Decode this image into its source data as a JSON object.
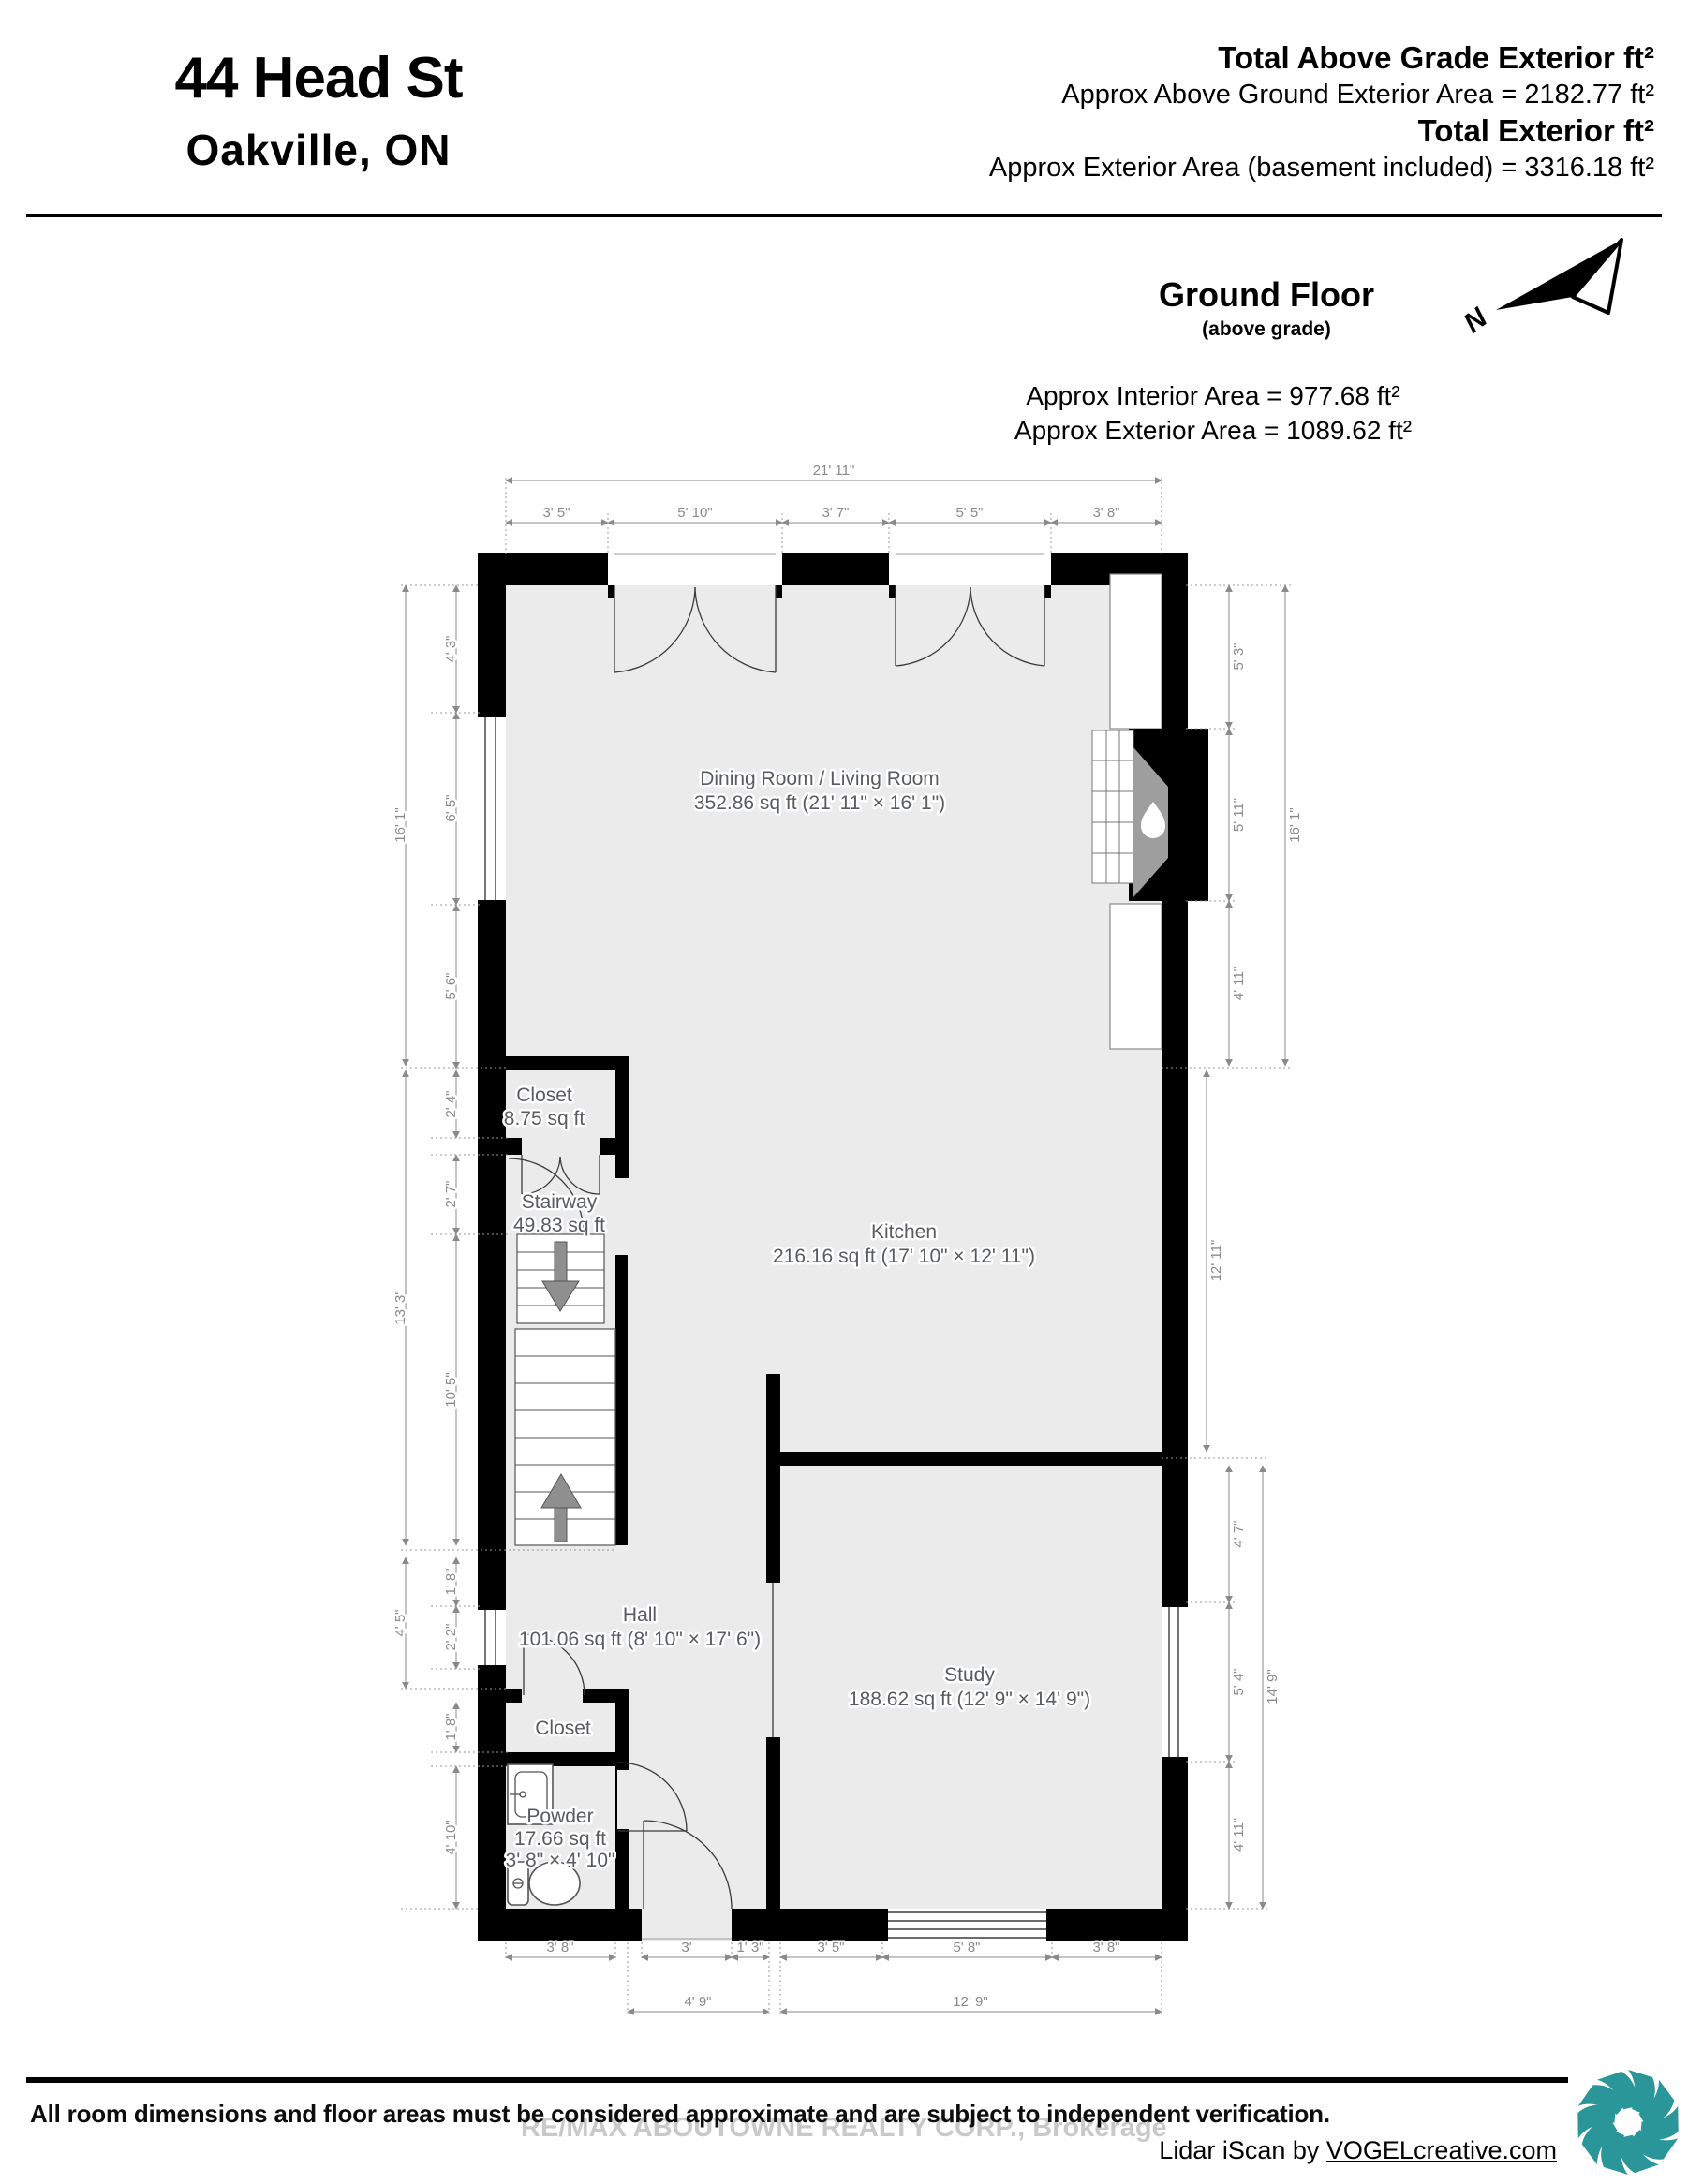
{
  "header": {
    "address_line1": "44 Head St",
    "address_line2": "Oakville,  ON",
    "total_above_grade_label": "Total Above Grade Exterior ft²",
    "total_above_grade_value": "Approx Above Ground Exterior Area = 2182.77 ft²",
    "total_exterior_label": "Total Exterior ft²",
    "total_exterior_value": "Approx Exterior Area (basement included) = 3316.18 ft²"
  },
  "floor": {
    "title": "Ground Floor",
    "subtitle": "(above grade)",
    "north_label": "N",
    "interior_area": "Approx Interior Area = 977.68 ft²",
    "exterior_area": "Approx Exterior Area = 1089.62 ft²"
  },
  "rooms": {
    "dining": {
      "name": "Dining Room / Living Room",
      "area": "352.86 sq ft (21' 11\" × 16' 1\")"
    },
    "closet_upper": {
      "name": "Closet",
      "area": "8.75 sq ft"
    },
    "stairway": {
      "name": "Stairway",
      "area": "49.83 sq ft"
    },
    "kitchen": {
      "name": "Kitchen",
      "area": "216.16 sq ft (17' 10\" × 12' 11\")"
    },
    "hall": {
      "name": "Hall",
      "area": "101.06 sq ft (8' 10\" × 17' 6\")"
    },
    "closet_lower": {
      "name": "Closet"
    },
    "powder": {
      "name": "Powder",
      "area": "17.66 sq ft",
      "size": "3' 8\" × 4' 10\""
    },
    "study": {
      "name": "Study",
      "area": "188.62 sq ft (12' 9\" × 14' 9\")"
    }
  },
  "dims": {
    "top_overall": "21' 11\"",
    "top": [
      "3' 5\"",
      "5' 10\"",
      "3' 7\"",
      "5' 5\"",
      "3' 8\""
    ],
    "left_outer": [
      "16' 1\"",
      "13' 3\"",
      "4' 5\""
    ],
    "left_inner": [
      "4' 3\"",
      "6' 5\"",
      "5' 6\"",
      "2' 4\"",
      "2' 7\"",
      "10' 5\"",
      "1' 8\"",
      "2' 2\"",
      "1' 8\"",
      "4' 10\""
    ],
    "right_dining": [
      "5' 3\"",
      "5' 11\"",
      "4' 11\""
    ],
    "right_dining_overall": "16' 1\"",
    "right_kitchen": "12' 11\"",
    "right_study": [
      "4' 7\"",
      "5' 4\"",
      "4' 11\""
    ],
    "right_study_overall": "14' 9\"",
    "bottom": [
      "3' 8\"",
      "3'",
      "1' 3\"",
      "3' 5\"",
      "5' 8\"",
      "3' 8\""
    ],
    "bottom_overall_hall": "4' 9\"",
    "bottom_overall_study": "12' 9\""
  },
  "footer": {
    "disclaimer": "All room dimensions and floor areas must be considered approximate and are subject to independent verification.",
    "watermark": "RE/MAX ABOUTOWNE REALTY CORP., Brokerage",
    "credit_prefix": "Lidar iScan by ",
    "credit_link": "VOGELcreative.com"
  },
  "colors": {
    "wall": "#000000",
    "floor": "#ebebeb",
    "dimension": "#8a8a8a",
    "room_label": "#585c60",
    "logo_teal": "#2a9699",
    "fireplace_grey": "#9e9e9e"
  }
}
